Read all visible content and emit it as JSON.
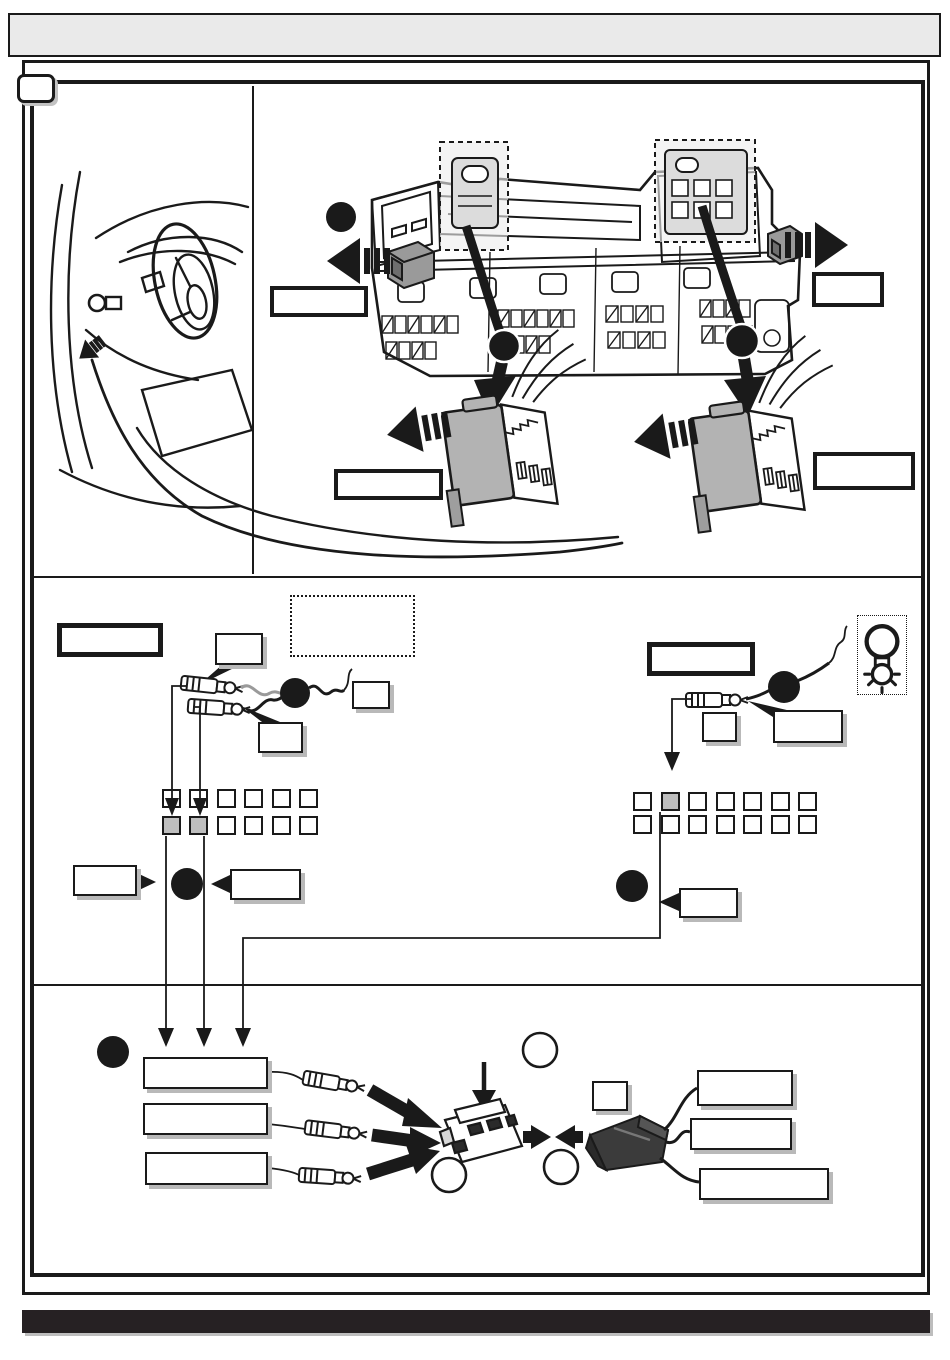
{
  "document": {
    "kind": "vehicle-wiring-installation-diagram",
    "page_contains_text": false,
    "header": {
      "title": ""
    },
    "footer": {
      "text": ""
    },
    "step": {
      "number": ""
    }
  },
  "colors": {
    "ink": "#1a1a1a",
    "paper": "#ffffff",
    "header_fill": "#eaeaea",
    "footer_fill": "#262123",
    "connector_gray": "#b3b3b3",
    "small_connector_gray": "#9a9a9a",
    "highlight_zone_gray": "#ededed",
    "grid_highlight_gray": "#bfbfbf",
    "shadow_gray": "#b9b9b9"
  },
  "top_section": {
    "illustrations": [
      "steering-wheel-dashboard",
      "vehicle-fuse-box"
    ],
    "callout_dots": [
      {
        "id": "dot-fusebox-left",
        "label": ""
      },
      {
        "id": "dot-wire-left",
        "label": ""
      },
      {
        "id": "dot-wire-right",
        "label": ""
      }
    ],
    "labels": {
      "module_left": "",
      "module_right": "",
      "connector1": "",
      "connector2": ""
    }
  },
  "middle_left": {
    "labels": {
      "title": "",
      "note_box": "",
      "wire1": "",
      "wire2": "",
      "inline_box": "",
      "pin_left": "",
      "pin_right": ""
    },
    "fuse_grid": {
      "cols": 6,
      "rows": 2,
      "highlighted_cells": [
        {
          "row": 1,
          "col": 0
        },
        {
          "row": 1,
          "col": 1
        }
      ]
    }
  },
  "middle_right": {
    "labels": {
      "title": "",
      "inline_box": "",
      "wire": "",
      "pin": ""
    },
    "icons": [
      "bulb-icon"
    ],
    "fuse_grid": {
      "cols": 7,
      "rows": 2,
      "highlighted_cells": [
        {
          "row": 0,
          "col": 1
        }
      ]
    }
  },
  "bottom_section": {
    "labels": {
      "wire1": "",
      "wire2": "",
      "wire3": "",
      "inline_box": "",
      "out_wire1": "",
      "out_wire2": "",
      "out_wire3": ""
    },
    "callout_dots": [
      {
        "id": "dot-harness",
        "label": ""
      }
    ],
    "open_circles": [
      {
        "id": "circle-top",
        "label": ""
      },
      {
        "id": "circle-left",
        "label": ""
      },
      {
        "id": "circle-right",
        "label": ""
      }
    ]
  }
}
